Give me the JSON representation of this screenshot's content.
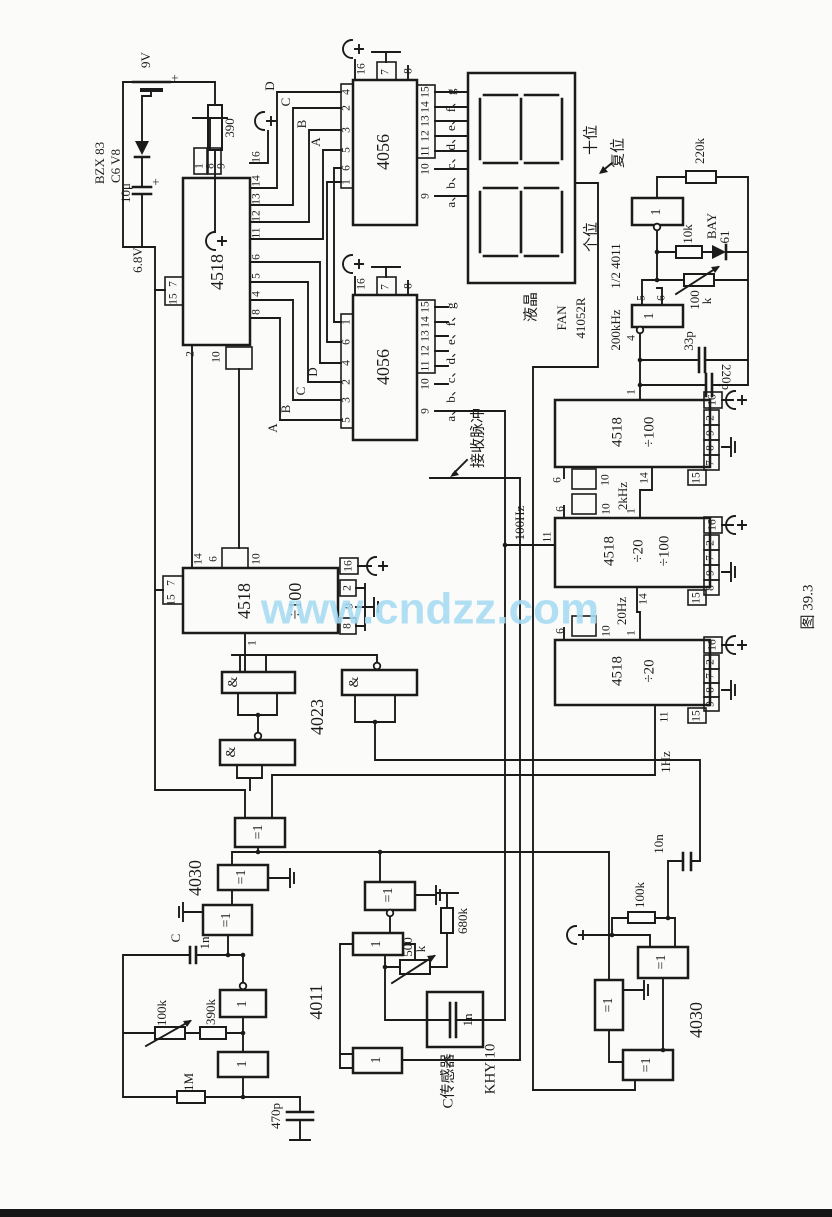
{
  "watermark": "www.cndzz.com",
  "caption": "图 39.3",
  "pulse_label": "接收脉冲",
  "colors": {
    "ink": "#1b1b1b",
    "watermark": "#a6dcf4",
    "paper": "#fbfbf9"
  },
  "gates": {
    "and": "&",
    "xor": "=1",
    "nand": "1"
  },
  "power": {
    "v9": "9V",
    "plus": "+",
    "r390": "390",
    "zener1": "BZX 83",
    "zener2": "C6 V8",
    "cap10u": "10μ",
    "rail": "6.8V"
  },
  "bus": {
    "a": "A",
    "b": "B",
    "c": "C",
    "d": "D"
  },
  "u4518": {
    "name": "4518",
    "top": [
      "1",
      "8",
      "9"
    ],
    "right": [
      "16",
      "14",
      "13",
      "12",
      "11",
      "6",
      "5",
      "4",
      "8"
    ],
    "left": [
      "7",
      "15"
    ],
    "bottom": [
      "2",
      "10"
    ]
  },
  "u4056a": {
    "name": "4056",
    "top": [
      "16",
      "7",
      "8"
    ],
    "lp": [
      "4",
      "2",
      "3",
      "5",
      "6",
      "1"
    ],
    "rp": [
      "15",
      "14",
      "13",
      "12",
      "11",
      "10",
      "9"
    ],
    "seg": "a、b、c、d、e、f、g"
  },
  "u4056b": {
    "name": "4056",
    "top": [
      "16",
      "7",
      "8"
    ],
    "lp": [
      "1",
      "6",
      "4",
      "2",
      "3",
      "5"
    ],
    "rp": [
      "15",
      "14",
      "13",
      "12",
      "11",
      "10",
      "9"
    ],
    "seg": "a、b、c、d、e、f、g"
  },
  "lcd": {
    "type": "液晶",
    "brand": "FAN",
    "model": "41052R",
    "tens": "十位",
    "units": "个位",
    "reset": "复位"
  },
  "osc": {
    "ic": "1/2 4011",
    "freq": "200kHz",
    "r220k": "220k",
    "r10k": "10k",
    "d1": "BAY",
    "d2": "61",
    "pot": "100",
    "potu": "k",
    "c33": "33p",
    "c220": "220p",
    "p4": "4",
    "p5": "5",
    "p6": "6"
  },
  "divA": {
    "name": "4518",
    "ratio": "÷100",
    "out": "2kHz",
    "p1": "1",
    "p6": "6",
    "p10": "10",
    "p14": "14",
    "p16": "16",
    "p2": "2",
    "p9": "9",
    "p8": "8",
    "p7": "7",
    "p15": "15"
  },
  "divB": {
    "name": "4518",
    "ratio1": "÷20",
    "ratio2": "÷100",
    "in": "100Hz",
    "out": "20Hz",
    "p11": "11",
    "p1": "1",
    "p6": "6",
    "p10": "10",
    "p14": "14",
    "p16": "16",
    "p2": "2",
    "p7": "7",
    "p9": "9",
    "p8": "8",
    "p15": "15"
  },
  "divC": {
    "name": "4518",
    "ratio": "÷20",
    "out": "1Hz",
    "p1": "1",
    "p6": "6",
    "p10": "10",
    "p11": "11",
    "p16": "16",
    "p2": "2",
    "p7": "7",
    "p8": "8",
    "p9": "9",
    "p15": "15"
  },
  "mid4518": {
    "name": "4518",
    "ratio": "÷100",
    "p14": "14",
    "p6": "6",
    "p10": "10",
    "p7": "7",
    "p15": "15",
    "p16": "16",
    "p2": "2",
    "p9": "9",
    "p8": "8",
    "p1": "1"
  },
  "u4023": {
    "name": "4023"
  },
  "u4030L": {
    "name": "4030"
  },
  "u4030R": {
    "name": "4030"
  },
  "u4011": {
    "name": "4011"
  },
  "rc": {
    "c": "C",
    "c1n": "1n",
    "r100k": "100k",
    "r390k": "390k",
    "r1m": "1M",
    "c470": "470p"
  },
  "sensor": {
    "r500": "500",
    "r500u": "k",
    "r680": "680k",
    "c1n": "1n",
    "label": "C传感器",
    "model": "KHY 10"
  },
  "br": {
    "c10n": "10n",
    "r100k": "100k"
  }
}
